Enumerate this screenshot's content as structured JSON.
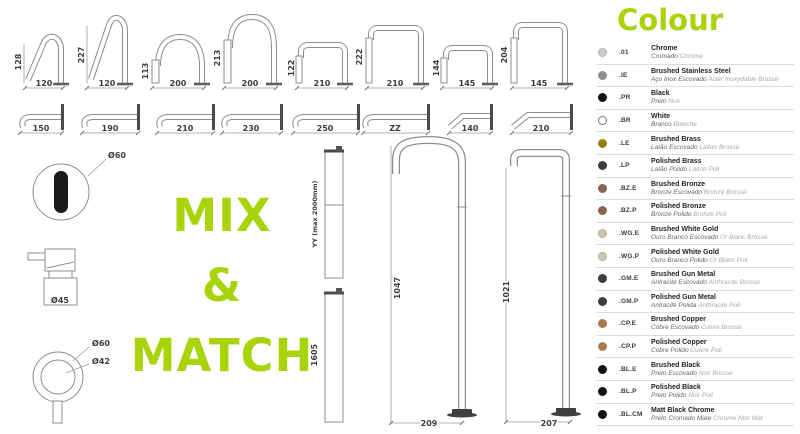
{
  "accent": "#a9d40b",
  "mix_match": {
    "line1": "MIX",
    "line2": "&",
    "line3": "MATCH"
  },
  "diagrams": {
    "row1": [
      {
        "h": "128",
        "w": "120"
      },
      {
        "h": "227",
        "w": "120"
      },
      {
        "h": "113",
        "w": "200"
      },
      {
        "h": "213",
        "w": "200"
      },
      {
        "h": "122",
        "w": "210"
      },
      {
        "h": "222",
        "w": "210"
      },
      {
        "h": "144",
        "w": "145"
      },
      {
        "h": "204",
        "w": "145"
      }
    ],
    "row2": [
      {
        "w": "150"
      },
      {
        "w": "190"
      },
      {
        "w": "210"
      },
      {
        "w": "230"
      },
      {
        "w": "250"
      },
      {
        "w": "ZZ"
      },
      {
        "w": "140"
      },
      {
        "w": "210"
      }
    ],
    "left": {
      "sensor_diameter": "Ø60",
      "mixer_diameter": "Ø45",
      "handle_outer": "Ø60",
      "handle_inner": "Ø42"
    },
    "risers": {
      "adjustable": "YY (max 2000mm)",
      "fixed": "1605"
    },
    "floor1": {
      "h": "1047",
      "w": "209"
    },
    "floor2": {
      "h": "1021",
      "w": "207"
    }
  },
  "legend": {
    "title": "Colour",
    "items": [
      {
        "code": ".01",
        "name": "Chrome",
        "pt": "Cromado",
        "fr": "Chrome",
        "color": "#cbcbcb",
        "border": "#b5b5b5"
      },
      {
        "code": ".IE",
        "name": "Brushed Stainless Steel",
        "pt": "Aço Inox Escovado",
        "fr": "Acier Inoxydable Brossé",
        "color": "#8f8f8f"
      },
      {
        "code": ".PR",
        "name": "Black",
        "pt": "Preto",
        "fr": "Noir",
        "color": "#111111"
      },
      {
        "code": ".BR",
        "name": "White",
        "pt": "Branco",
        "fr": "Blanche",
        "color": "#ffffff",
        "border": "#777777"
      },
      {
        "code": ".LE",
        "name": "Brushed Brass",
        "pt": "Latão Escovado",
        "fr": "Laiton Brossé",
        "color": "#93800b"
      },
      {
        "code": ".LP",
        "name": "Polished Brass",
        "pt": "Latão Polido",
        "fr": "Laiton Poli",
        "color": "#3e3c33"
      },
      {
        "code": ".BZ.E",
        "name": "Brushed Bronze",
        "pt": "Bronze Escovado",
        "fr": "Bronze Brossé",
        "color": "#8d6355"
      },
      {
        "code": ".BZ.P",
        "name": "Polished Bronze",
        "pt": "Bronze Polido",
        "fr": "Bronze Poli",
        "color": "#8d6355"
      },
      {
        "code": ".WG.E",
        "name": "Brushed White Gold",
        "pt": "Ouro Branco Escovado",
        "fr": "Or Blanc Brossé",
        "color": "#cdc3ae",
        "border": "#b9ad94"
      },
      {
        "code": ".WG.P",
        "name": "Polished White Gold",
        "pt": "Ouro Branco Polido",
        "fr": "Or Blanc Poli",
        "color": "#cdc3ae",
        "border": "#b9ad94"
      },
      {
        "code": ".GM.E",
        "name": "Brushed Gun Metal",
        "pt": "Antracite Escovado",
        "fr": "Anthracite Brossé",
        "color": "#3d3d3d"
      },
      {
        "code": ".GM.P",
        "name": "Polished Gun Metal",
        "pt": "Antracite Polida",
        "fr": "Anthracite Poli",
        "color": "#3d3d3d"
      },
      {
        "code": ".CP.E",
        "name": "Brushed Copper",
        "pt": "Cobre Escovado",
        "fr": "Cuivre Brossé",
        "color": "#a97a4e"
      },
      {
        "code": ".CP.P",
        "name": "Polished Copper",
        "pt": "Cobre Polido",
        "fr": "Cuivre Poli",
        "color": "#a97a4e"
      },
      {
        "code": ".BL.E",
        "name": "Brushed Black",
        "pt": "Preto Escovado",
        "fr": "Noir Brossé",
        "color": "#111111"
      },
      {
        "code": ".BL.P",
        "name": "Polished Black",
        "pt": "Preto Polido",
        "fr": "Noir Poli",
        "color": "#111111"
      },
      {
        "code": ".BL.CM",
        "name": "Matt Black Chrome",
        "pt": "Preto Cromado Mate",
        "fr": "Chrome Noir Mat",
        "color": "#111111"
      }
    ]
  }
}
